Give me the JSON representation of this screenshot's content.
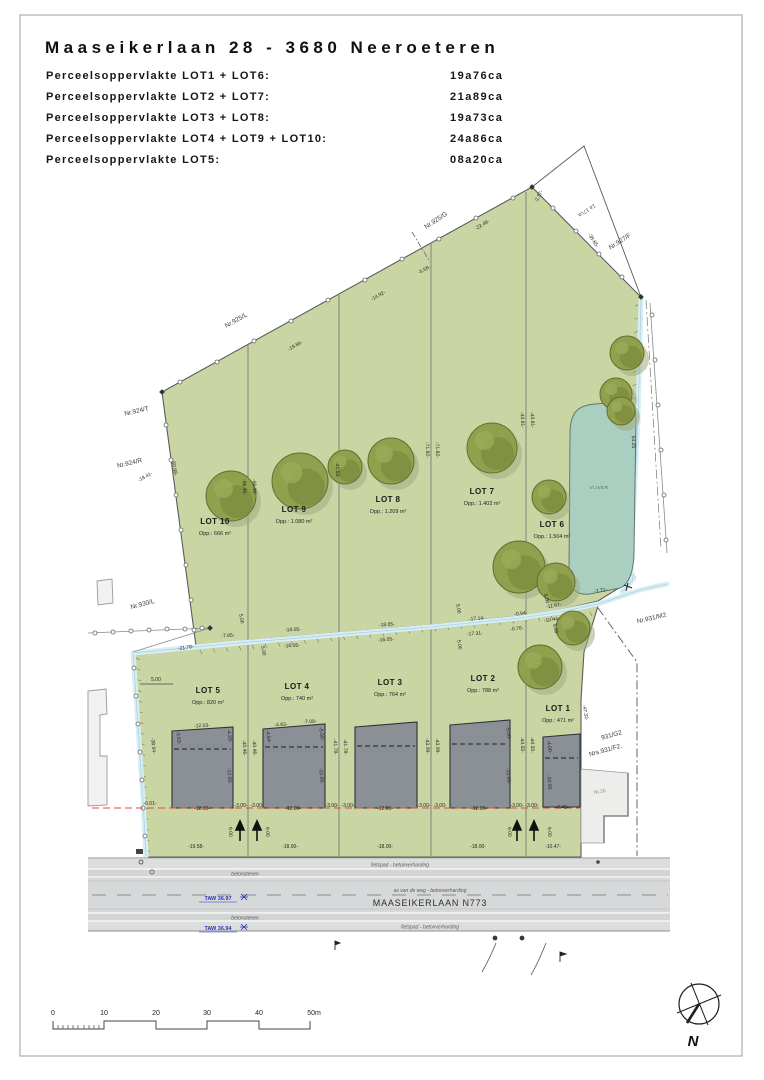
{
  "header": {
    "title": "Maaseikerlaan 28 - 3680 Neeroeteren",
    "rows": [
      {
        "label": "Perceelsoppervlakte LOT1 + LOT6:",
        "value": "19a76ca"
      },
      {
        "label": "Perceelsoppervlakte LOT2 + LOT7:",
        "value": "21a89ca"
      },
      {
        "label": "Perceelsoppervlakte LOT3 + LOT8:",
        "value": "19a73ca"
      },
      {
        "label": "Perceelsoppervlakte LOT4 + LOT9 + LOT10:",
        "value": "24a86ca"
      },
      {
        "label": "Perceelsoppervlakte LOT5:",
        "value": "08a20ca"
      }
    ]
  },
  "plan": {
    "lots": [
      {
        "name": "LOT 10",
        "area": "Opp.: 666 m²"
      },
      {
        "name": "LOT 9",
        "area": "Opp.: 1.080 m²"
      },
      {
        "name": "LOT 8",
        "area": "Opp.: 1.209 m²"
      },
      {
        "name": "LOT 7",
        "area": "Opp.: 1.402 m²"
      },
      {
        "name": "LOT 6",
        "area": "Opp.: 1.504 m²"
      },
      {
        "name": "LOT 5",
        "area": "Opp.: 820 m²"
      },
      {
        "name": "LOT 4",
        "area": "Opp.: 740 m²"
      },
      {
        "name": "LOT 3",
        "area": "Opp.: 764 m²"
      },
      {
        "name": "LOT 2",
        "area": "Opp.: 788 m²"
      },
      {
        "name": "LOT 1",
        "area": "Opp.: 471 m²"
      }
    ],
    "parcels": [
      {
        "label": "Nr.925/G"
      },
      {
        "label": "Nr.927/F"
      },
      {
        "label": "Nr.925/L"
      },
      {
        "label": "Nr.924/T"
      },
      {
        "label": "Nr.924/R"
      },
      {
        "label": "Nr.930/L"
      },
      {
        "label": "Nr.931/M2"
      },
      {
        "label": "931/G2"
      },
      {
        "label": "Nrs.931/F2."
      },
      {
        "label": "Nr.26"
      }
    ],
    "triangle_label": "1a 17ca",
    "pond_label": "VIJVER",
    "road": {
      "name": "MAASEIKERLAAN  N773",
      "axis_label": "as van de weg - betonverharding",
      "cycle_label": "fietspad - betonverharding",
      "stones_label": "betonstenen",
      "taw_top": "TAW 36.97",
      "taw_bottom": "TAW 36.94"
    },
    "north_label": "N",
    "scalebar": [
      "0",
      "10",
      "20",
      "30",
      "40",
      "50m"
    ],
    "dims": [
      {
        "t": "-18.41-",
        "x": 146,
        "y": 478,
        "r": -29
      },
      {
        "t": "-19.84-",
        "x": 296,
        "y": 347,
        "r": -29
      },
      {
        "t": "-14.92-",
        "x": 379,
        "y": 297,
        "r": -29
      },
      {
        "t": "-5.58-",
        "x": 425,
        "y": 271,
        "r": -29
      },
      {
        "t": "-22.49-",
        "x": 483,
        "y": 226,
        "r": -31
      },
      {
        "t": "-2.37-",
        "x": 540,
        "y": 197,
        "r": -62
      },
      {
        "t": "-38.85-",
        "x": 592,
        "y": 241,
        "r": 58
      },
      {
        "t": "-50.68-",
        "x": 173,
        "y": 468,
        "r": 80
      },
      {
        "t": "-56.46-",
        "x": 243,
        "y": 487,
        "r": 87
      },
      {
        "t": "-56.46-",
        "x": 253,
        "y": 487,
        "r": 87
      },
      {
        "t": "-41.53-",
        "x": 336,
        "y": 470,
        "r": 87
      },
      {
        "t": "-71.82-",
        "x": 426,
        "y": 450,
        "r": 87
      },
      {
        "t": "-71.82-",
        "x": 436,
        "y": 450,
        "r": 87
      },
      {
        "t": "-43.81-",
        "x": 521,
        "y": 420,
        "r": 87
      },
      {
        "t": "-43.81-",
        "x": 531,
        "y": 420,
        "r": 87
      },
      {
        "t": "54.25",
        "x": 632,
        "y": 442,
        "r": 88
      },
      {
        "t": "-7.85-",
        "x": 228,
        "y": 637,
        "r": -3
      },
      {
        "t": "-18.05-",
        "x": 293,
        "y": 631,
        "r": -3
      },
      {
        "t": "-18.05-",
        "x": 292,
        "y": 647,
        "r": -3
      },
      {
        "t": "-18.05-",
        "x": 387,
        "y": 626,
        "r": -4
      },
      {
        "t": "-16.05-",
        "x": 386,
        "y": 641,
        "r": -4
      },
      {
        "t": "-17.14-",
        "x": 477,
        "y": 620,
        "r": -5
      },
      {
        "t": "-17.31-",
        "x": 475,
        "y": 635,
        "r": -5
      },
      {
        "t": "-0.94-",
        "x": 521,
        "y": 615,
        "r": -6
      },
      {
        "t": "-0.76-",
        "x": 517,
        "y": 630,
        "r": -6
      },
      {
        "t": "-11.67-",
        "x": 554,
        "y": 607,
        "r": -9
      },
      {
        "t": "-10.44-",
        "x": 552,
        "y": 621,
        "r": -9
      },
      {
        "t": "-7.71-",
        "x": 601,
        "y": 592,
        "r": -11
      },
      {
        "t": "-21.78-",
        "x": 186,
        "y": 649,
        "r": -9
      },
      {
        "t": "5.00",
        "x": 156,
        "y": 681,
        "r": 0
      },
      {
        "t": "5.00",
        "x": 240,
        "y": 619,
        "r": 80
      },
      {
        "t": "5.00",
        "x": 262,
        "y": 651,
        "r": 80
      },
      {
        "t": "5.00",
        "x": 457,
        "y": 609,
        "r": 80
      },
      {
        "t": "5.00",
        "x": 458,
        "y": 645,
        "r": 80
      },
      {
        "t": "5.00",
        "x": 545,
        "y": 599,
        "r": 75
      },
      {
        "t": "5.00",
        "x": 554,
        "y": 629,
        "r": 75
      },
      {
        "t": "-38.94-",
        "x": 152,
        "y": 746,
        "r": 84
      },
      {
        "t": "-40.46-",
        "x": 243,
        "y": 748,
        "r": 87
      },
      {
        "t": "-40.46-",
        "x": 253,
        "y": 748,
        "r": 87
      },
      {
        "t": "-41.78-",
        "x": 334,
        "y": 747,
        "r": 87
      },
      {
        "t": "-41.78-",
        "x": 344,
        "y": 747,
        "r": 87
      },
      {
        "t": "-43.09-",
        "x": 426,
        "y": 746,
        "r": 87
      },
      {
        "t": "-43.09-",
        "x": 436,
        "y": 746,
        "r": 87
      },
      {
        "t": "-44.55-",
        "x": 521,
        "y": 745,
        "r": 87
      },
      {
        "t": "-44.55-",
        "x": 531,
        "y": 745,
        "r": 87
      },
      {
        "t": "-47.32-",
        "x": 584,
        "y": 713,
        "r": 80
      },
      {
        "t": "-12.03-",
        "x": 202,
        "y": 727,
        "r": -3
      },
      {
        "t": "-3.53-",
        "x": 177,
        "y": 738,
        "r": 82
      },
      {
        "t": "-4.20-",
        "x": 228,
        "y": 736,
        "r": 82
      },
      {
        "t": "-12.00-",
        "x": 228,
        "y": 776,
        "r": 86
      },
      {
        "t": "-4.93-",
        "x": 281,
        "y": 726,
        "r": -3
      },
      {
        "t": "-7.09-",
        "x": 310,
        "y": 723,
        "r": -3
      },
      {
        "t": "-4.64-",
        "x": 267,
        "y": 737,
        "r": 82
      },
      {
        "t": "-5.00-",
        "x": 320,
        "y": 734,
        "r": 82
      },
      {
        "t": "-12.00-",
        "x": 320,
        "y": 776,
        "r": 86
      },
      {
        "t": "-5.00-",
        "x": 507,
        "y": 733,
        "r": 82
      },
      {
        "t": "-12.00-",
        "x": 507,
        "y": 776,
        "r": 86
      },
      {
        "t": "-4.00-",
        "x": 548,
        "y": 747,
        "r": 82
      },
      {
        "t": "-10.00-",
        "x": 548,
        "y": 783,
        "r": 86
      },
      {
        "t": "-6.01-",
        "x": 150,
        "y": 805,
        "r": 0
      },
      {
        "t": "-12.00-",
        "x": 202,
        "y": 810,
        "r": 0
      },
      {
        "t": "-3.00-",
        "x": 241,
        "y": 807,
        "r": 0
      },
      {
        "t": "-3.00-",
        "x": 257,
        "y": 807,
        "r": 0
      },
      {
        "t": "-12.00-",
        "x": 293,
        "y": 810,
        "r": 0
      },
      {
        "t": "-3.00-",
        "x": 332,
        "y": 807,
        "r": 0
      },
      {
        "t": "-3.00-",
        "x": 348,
        "y": 807,
        "r": 0
      },
      {
        "t": "-12.00-",
        "x": 385,
        "y": 810,
        "r": 0
      },
      {
        "t": "-3.00-",
        "x": 424,
        "y": 807,
        "r": 0
      },
      {
        "t": "-3.00-",
        "x": 440,
        "y": 807,
        "r": 0
      },
      {
        "t": "-12.00-",
        "x": 479,
        "y": 810,
        "r": 0
      },
      {
        "t": "-3.00-",
        "x": 517,
        "y": 807,
        "r": 0
      },
      {
        "t": "-3.00-",
        "x": 532,
        "y": 807,
        "r": 0
      },
      {
        "t": "-7.40-",
        "x": 562,
        "y": 809,
        "r": 0
      },
      {
        "t": "9.00",
        "x": 229,
        "y": 832,
        "r": 85
      },
      {
        "t": "9.00",
        "x": 266,
        "y": 832,
        "r": 85
      },
      {
        "t": "9.00",
        "x": 508,
        "y": 832,
        "r": 85
      },
      {
        "t": "9.00",
        "x": 548,
        "y": 832,
        "r": 85
      },
      {
        "t": "-19.58-",
        "x": 196,
        "y": 848,
        "r": 0
      },
      {
        "t": "-18.00-",
        "x": 290,
        "y": 848,
        "r": 0
      },
      {
        "t": "-18.00-",
        "x": 385,
        "y": 848,
        "r": 0
      },
      {
        "t": "-18.00-",
        "x": 478,
        "y": 848,
        "r": 0
      },
      {
        "t": "-10.47-",
        "x": 553,
        "y": 848,
        "r": 0
      }
    ]
  }
}
